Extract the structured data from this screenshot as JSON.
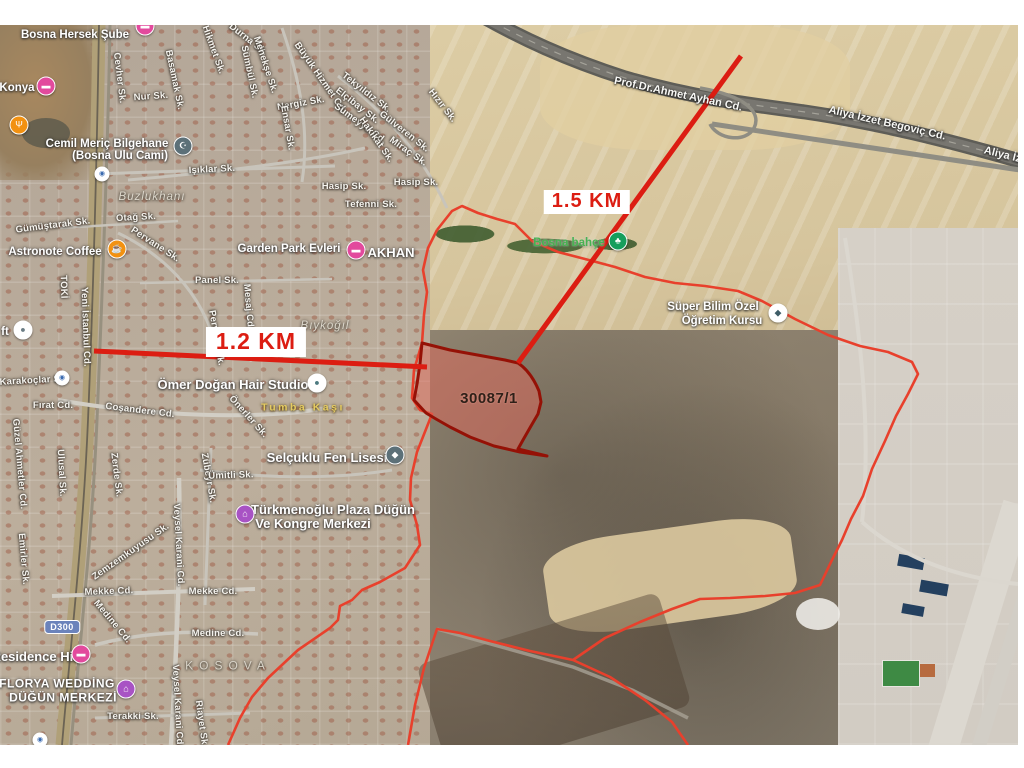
{
  "map": {
    "colors": {
      "measure_red": "#dc1d12",
      "boundary_red": "#e8402c",
      "parcel_stroke": "#951106",
      "parcel_fill": "rgba(222,106,92,0.52)",
      "pin_pink": "#e24a9d",
      "pin_purple": "#a853c4",
      "pin_orange": "#f29111",
      "pin_slate": "#5c7078",
      "pin_green": "#159e5c",
      "pin_white": "#ffffff"
    },
    "measure_labels": [
      {
        "t": "1.5 KM",
        "x": 587,
        "y": 202,
        "sm": true,
        "n": "distance-label-1-5-km"
      },
      {
        "t": "1.2 KM",
        "x": 256,
        "y": 342,
        "sm": false,
        "n": "distance-label-1-2-km"
      }
    ],
    "labels": [
      {
        "t": "30087/1",
        "x": 489,
        "y": 399,
        "c": "parcel-num",
        "n": "parcel-number-label"
      },
      {
        "t": "Bosna Hersek Şube",
        "x": 75,
        "y": 35,
        "c": "poi",
        "n": "poi-label-bosna-hersek-sube",
        "i": true
      },
      {
        "t": "Konya",
        "x": 17,
        "y": 88,
        "c": "poi",
        "n": "poi-label-konya",
        "i": true
      },
      {
        "t": "Cemil Meriç Bilgehane",
        "x": 107,
        "y": 144,
        "c": "poi",
        "n": "poi-label-cemil-meric-bilgehane",
        "i": true
      },
      {
        "t": "(Bosna Ulu Cami)",
        "x": 120,
        "y": 156,
        "c": "poi",
        "n": "poi-label-bosna-ulu-cami",
        "i": true
      },
      {
        "t": "Astronote Coffee",
        "x": 55,
        "y": 252,
        "c": "poi",
        "n": "poi-label-astronote-coffee",
        "i": true
      },
      {
        "t": "Garden Park Evleri",
        "x": 289,
        "y": 249,
        "c": "poi",
        "n": "poi-label-garden-park-evleri",
        "i": true
      },
      {
        "t": "AKHAN",
        "x": 391,
        "y": 253,
        "c": "poi-lg",
        "n": "poi-label-akhan",
        "i": true
      },
      {
        "t": "ft",
        "x": 5,
        "y": 332,
        "c": "poi",
        "n": "poi-label-ft",
        "i": true
      },
      {
        "t": "Ömer Doğan Hair Studio",
        "x": 233,
        "y": 385,
        "c": "poi-lg",
        "n": "poi-label-omer-dogan-hair-studio",
        "i": true
      },
      {
        "t": "Bosna bahçe",
        "x": 569,
        "y": 243,
        "c": "green-label",
        "n": "poi-label-bosna-bahce",
        "i": true
      },
      {
        "t": "Süper Bilim Özel",
        "x": 713,
        "y": 307,
        "c": "poi",
        "n": "poi-label-super-bilim-ozel",
        "i": true
      },
      {
        "t": "Öğretim Kursu",
        "x": 722,
        "y": 321,
        "c": "poi",
        "n": "poi-label-ogretim-kursu",
        "i": true
      },
      {
        "t": "Selçuklu Fen Lisesi",
        "x": 327,
        "y": 458,
        "c": "poi-lg",
        "n": "poi-label-selcuklu-fen-lisesi",
        "i": true
      },
      {
        "t": "Türkmenoğlu Plaza Düğün",
        "x": 333,
        "y": 510,
        "c": "poi-lg",
        "n": "poi-label-turkmenoglu-plaza",
        "i": true
      },
      {
        "t": "Ve Kongre Merkezi",
        "x": 313,
        "y": 524,
        "c": "poi-lg",
        "n": "poi-label-kongre-merkezi",
        "i": true
      },
      {
        "t": "Residence Hill",
        "x": 36,
        "y": 657,
        "c": "poi-lg",
        "n": "poi-label-residence-hill",
        "i": true
      },
      {
        "t": "FLORYA WEDDİNG",
        "x": 57,
        "y": 684,
        "c": "poi-caps",
        "n": "poi-label-florya-wedding",
        "i": true
      },
      {
        "t": "DÜĞÜN MERKEZİ",
        "x": 63,
        "y": 698,
        "c": "poi-caps",
        "n": "poi-label-dugun-merkezi",
        "i": true
      },
      {
        "t": "Buzlukhanı",
        "x": 152,
        "y": 197,
        "c": "district",
        "n": "district-label-buzlukhani"
      },
      {
        "t": "Bıykoğıl",
        "x": 325,
        "y": 326,
        "c": "district",
        "n": "district-label-biykogil"
      },
      {
        "t": "KOSOVA",
        "x": 228,
        "y": 666,
        "c": "caps",
        "n": "district-label-kosova"
      },
      {
        "t": "Tumba Kaşı",
        "x": 303,
        "y": 408,
        "c": "yellow",
        "n": "area-label-tumba-kasi"
      },
      {
        "t": "Prof.Dr.Ahmet Ayhan Cd.",
        "x": 678,
        "y": 95,
        "r": 12,
        "c": "road-label",
        "n": "road-label-prof-dr-ahmet-ayhan"
      },
      {
        "t": "Aliya İzzet Begoviç Cd.",
        "x": 887,
        "y": 124,
        "r": 13,
        "c": "road-label",
        "n": "road-label-aliya-izzet-begovic"
      },
      {
        "t": "Aliya İzze",
        "x": 1008,
        "y": 157,
        "r": 14,
        "c": "road-label",
        "n": "road-label-aliya-izzet-edge"
      },
      {
        "t": "Cevher Sk.",
        "x": 119,
        "y": 78,
        "r": 83
      },
      {
        "t": "Nur Sk.",
        "x": 151,
        "y": 97,
        "r": -4
      },
      {
        "t": "Basamak Sk.",
        "x": 174,
        "y": 80,
        "r": 78
      },
      {
        "t": "Hikmet Sk.",
        "x": 213,
        "y": 50,
        "r": 70
      },
      {
        "t": "Durna Sk.",
        "x": 248,
        "y": 40,
        "r": 38
      },
      {
        "t": "Menekşe Sk.",
        "x": 265,
        "y": 65,
        "r": 72
      },
      {
        "t": "Sümbül Sk.",
        "x": 249,
        "y": 72,
        "r": 78
      },
      {
        "t": "Büyük Hizmet Cd.",
        "x": 320,
        "y": 78,
        "r": 55
      },
      {
        "t": "Nergiz Sk.",
        "x": 301,
        "y": 104,
        "r": -10
      },
      {
        "t": "Ensar Sk.",
        "x": 287,
        "y": 128,
        "r": 80
      },
      {
        "t": "Işıklar Sk.",
        "x": 212,
        "y": 170,
        "r": -3
      },
      {
        "t": "Tekyıldız Sk.",
        "x": 366,
        "y": 93,
        "r": 38
      },
      {
        "t": "Elçibay Sk.",
        "x": 357,
        "y": 106,
        "r": 38
      },
      {
        "t": "Sumeyye Cd.",
        "x": 360,
        "y": 124,
        "r": 36
      },
      {
        "t": "Hakikat Sk.",
        "x": 376,
        "y": 140,
        "r": 55
      },
      {
        "t": "Gülveren Sk.",
        "x": 404,
        "y": 132,
        "r": 38
      },
      {
        "t": "Miraç Sk.",
        "x": 408,
        "y": 152,
        "r": 35
      },
      {
        "t": "Hızır Sk.",
        "x": 442,
        "y": 106,
        "r": 52
      },
      {
        "t": "Hasip Sk.",
        "x": 344,
        "y": 187,
        "r": 0
      },
      {
        "t": "Hasip Sk.",
        "x": 416,
        "y": 183,
        "r": 0
      },
      {
        "t": "Tefenni Sk.",
        "x": 371,
        "y": 205,
        "r": 0
      },
      {
        "t": "Gümüştarak Sk.",
        "x": 53,
        "y": 226,
        "r": -7
      },
      {
        "t": "Otağ Sk.",
        "x": 136,
        "y": 218,
        "r": -3
      },
      {
        "t": "Pervane Sk.",
        "x": 155,
        "y": 245,
        "r": 33
      },
      {
        "t": "Pervane Sk.",
        "x": 216,
        "y": 338,
        "r": 80
      },
      {
        "t": "Panel Sk.",
        "x": 217,
        "y": 281,
        "r": 0
      },
      {
        "t": "Mesaj Cd.",
        "x": 248,
        "y": 307,
        "r": 85
      },
      {
        "t": "TOKİ",
        "x": 63,
        "y": 287,
        "r": 88
      },
      {
        "t": "Yeni İstanbul Cd.",
        "x": 85,
        "y": 327,
        "r": 88
      },
      {
        "t": "Karakoçlar Sk.",
        "x": 34,
        "y": 381,
        "r": -3
      },
      {
        "t": "Fırat Cd.",
        "x": 53,
        "y": 406,
        "r": 0
      },
      {
        "t": "Coşandere Cd.",
        "x": 140,
        "y": 411,
        "r": 7
      },
      {
        "t": "Önerler Sk.",
        "x": 248,
        "y": 417,
        "r": 48
      },
      {
        "t": "Güzel Ahmetler Cd.",
        "x": 19,
        "y": 464,
        "r": 85
      },
      {
        "t": "Ulusal Sk.",
        "x": 61,
        "y": 473,
        "r": 87
      },
      {
        "t": "Zerde Sk.",
        "x": 116,
        "y": 475,
        "r": 83
      },
      {
        "t": "Zübeyr Sk.",
        "x": 208,
        "y": 478,
        "r": 80
      },
      {
        "t": "Ümitli Sk.",
        "x": 231,
        "y": 476,
        "r": -2
      },
      {
        "t": "Veysel Karani Cd.",
        "x": 178,
        "y": 545,
        "r": 87
      },
      {
        "t": "Veysel Karani Cd.",
        "x": 177,
        "y": 706,
        "r": 87
      },
      {
        "t": "Zemzemkuyusu Sk.",
        "x": 131,
        "y": 552,
        "r": -35
      },
      {
        "t": "Emirler Sk.",
        "x": 23,
        "y": 559,
        "r": 85
      },
      {
        "t": "Mekke Cd.",
        "x": 109,
        "y": 592,
        "r": -2
      },
      {
        "t": "Mekke Cd.",
        "x": 213,
        "y": 592,
        "r": 0
      },
      {
        "t": "Medine Cd.",
        "x": 112,
        "y": 622,
        "r": 50
      },
      {
        "t": "Medine Cd.",
        "x": 218,
        "y": 634,
        "r": 0
      },
      {
        "t": "Terakki Sk.",
        "x": 133,
        "y": 717,
        "r": 0
      },
      {
        "t": "Riayet Sk.",
        "x": 201,
        "y": 724,
        "r": 82
      }
    ],
    "pins": [
      {
        "x": 145,
        "y": 26,
        "bg": "#e24a9d",
        "g": "▬",
        "n": "bank-branch-pin-icon"
      },
      {
        "x": 46,
        "y": 86,
        "bg": "#e24a9d",
        "g": "▬",
        "n": "hotel-pin-icon"
      },
      {
        "x": 19,
        "y": 125,
        "bg": "#f29111",
        "g": "Ψ",
        "n": "restaurant-pin-icon"
      },
      {
        "x": 183,
        "y": 146,
        "bg": "#5c7078",
        "g": "☪",
        "n": "mosque-pin-icon"
      },
      {
        "x": 117,
        "y": 249,
        "bg": "#f29111",
        "g": "☕",
        "n": "coffee-pin-icon"
      },
      {
        "x": 356,
        "y": 250,
        "bg": "#e24a9d",
        "g": "▬",
        "n": "akhan-pin-icon"
      },
      {
        "x": 23,
        "y": 330,
        "bg": "#ffffff",
        "g": "●",
        "fg": "#6b7d85",
        "n": "loft-pin-icon"
      },
      {
        "x": 317,
        "y": 383,
        "bg": "#ffffff",
        "g": "●",
        "fg": "#4d7a80",
        "n": "hair-studio-pin-icon"
      },
      {
        "x": 618,
        "y": 241,
        "bg": "#159e5c",
        "g": "♣",
        "n": "park-pin-icon"
      },
      {
        "x": 778,
        "y": 313,
        "bg": "#ffffff",
        "g": "◆",
        "fg": "#3e5c66",
        "n": "education-pin-icon"
      },
      {
        "x": 395,
        "y": 455,
        "bg": "#5c7078",
        "g": "◆",
        "n": "school-pin-icon"
      },
      {
        "x": 245,
        "y": 514,
        "bg": "#a853c4",
        "g": "⌂",
        "n": "plaza-pin-icon"
      },
      {
        "x": 81,
        "y": 654,
        "bg": "#e24a9d",
        "g": "▬",
        "n": "residence-pin-icon"
      },
      {
        "x": 126,
        "y": 689,
        "bg": "#a853c4",
        "g": "⌂",
        "n": "wedding-venue-pin-icon"
      },
      {
        "x": 102,
        "y": 174,
        "bg": "#ffffff",
        "g": "◉",
        "fg": "#3a6ab0",
        "sm": true,
        "n": "transit-stop-icon"
      },
      {
        "x": 62,
        "y": 378,
        "bg": "#ffffff",
        "g": "◉",
        "fg": "#3a6ab0",
        "sm": true,
        "n": "transit-stop-icon"
      },
      {
        "x": 40,
        "y": 740,
        "bg": "#ffffff",
        "g": "◉",
        "fg": "#3a6ab0",
        "sm": true,
        "n": "transit-stop-icon"
      }
    ],
    "shield": {
      "t": "D300",
      "x": 62,
      "y": 627,
      "n": "road-shield-d300"
    },
    "roads": [
      {
        "d": "M455,0 C520,40 575,62 625,78 C690,97 745,104 805,112 C880,123 950,141 1020,161",
        "s": "#5e5d57",
        "w": 15
      },
      {
        "d": "M455,0 C520,40 575,62 625,78 C690,97 745,104 805,112 C880,123 950,141 1020,161",
        "s": "#787670",
        "w": 10
      },
      {
        "d": "M455,0 C520,40 575,62 625,78 C690,97 745,104 805,112 C880,123 950,141 1020,161",
        "s": "#a5a39a",
        "w": 1.2,
        "da": "7 7"
      },
      {
        "d": "M712,124 C800,138 905,152 1020,170",
        "s": "#8f8d83",
        "w": 5
      },
      {
        "d": "M700,88 C745,96 762,112 754,128 C746,143 718,140 710,124",
        "s": "#8f8d83",
        "w": 3.5
      },
      {
        "d": "M99,25 C97,150 93,300 88,420 C83,540 70,650 62,745",
        "s": "#b0a078",
        "w": 13
      },
      {
        "d": "M99,25 C97,150 93,300 88,420 C83,540 70,650 62,745",
        "s": "#6b6354",
        "w": 1.8
      },
      {
        "d": "M110,25 C108,150 102,300 97,420 C92,540 79,650 71,745",
        "s": "#97907f",
        "w": 3
      },
      {
        "d": "M58,400 C150,416 260,421 332,407",
        "s": "#d2cec5",
        "w": 4
      },
      {
        "d": "M52,596 L255,589",
        "s": "#d2cec5",
        "w": 4
      },
      {
        "d": "M95,645 C150,630 205,631 258,634",
        "s": "#cbc7be",
        "w": 3.5
      },
      {
        "d": "M179,478 C181,560 176,660 171,745",
        "s": "#d2cec5",
        "w": 4.5
      },
      {
        "d": "M211,448 L205,605",
        "s": "#c8c4bb",
        "w": 3
      },
      {
        "d": "M95,174 L335,166",
        "s": "#c8c4bb",
        "w": 3
      },
      {
        "d": "M128,180 C220,172 305,162 365,148",
        "s": "#c8c4bb",
        "w": 3
      },
      {
        "d": "M118,233 C170,258 208,300 220,362",
        "s": "#c8c4bb",
        "w": 3
      },
      {
        "d": "M246,283 L251,362",
        "s": "#c8c4bb",
        "w": 2.5
      },
      {
        "d": "M140,283 L332,279",
        "s": "#c8c4bb",
        "w": 2.5
      },
      {
        "d": "M338,76 C380,108 420,150 447,208",
        "s": "#c8c4bb",
        "w": 3
      },
      {
        "d": "M282,28 C300,80 310,130 302,182",
        "s": "#c8c4bb",
        "w": 3
      },
      {
        "d": "M60,228 L178,221",
        "s": "#c8c4bb",
        "w": 2.5
      },
      {
        "d": "M200,470 C260,478 330,480 392,470",
        "s": "#c8c4bb",
        "w": 3
      },
      {
        "d": "M95,718 L250,713",
        "s": "#c8c4bb",
        "w": 3
      },
      {
        "d": "M845,238 C860,330 872,430 862,522",
        "s": "#dbd7cf",
        "w": 4
      },
      {
        "d": "M862,522 C905,560 960,578 1018,584",
        "s": "#dbd7cf",
        "w": 4
      },
      {
        "d": "M437,629 L573,667 632,690 688,718",
        "s": "#a8a195",
        "w": 3.5,
        "o": 0.8
      }
    ],
    "red": [
      {
        "d": "M437,230 L452,211 462,206 478,213 497,219 515,224 532,241 558,252 585,259 615,267 645,277 675,283 705,286 738,291 762,301 795,319 828,335 860,346 888,352 912,362 918,374 908,394 896,416 885,441 872,469 863,496 851,519 842,540 831,562 820,585 795,593 765,596 730,598 700,599 672,609 640,622 605,638 573,660 610,677 645,700 672,722 688,745",
        "s": "#e8402c",
        "w": 2.6,
        "n": "cadastral-boundary-line"
      },
      {
        "d": "M573,660 L530,651 490,641 460,633 437,629 424,668 415,705 408,745",
        "s": "#e8402c",
        "w": 2.6,
        "n": "cadastral-boundary-line"
      },
      {
        "d": "M437,230 L428,248 423,270 427,292 424,315 422,343 414,370 412,398 420,410 432,414 417,452 411,478 410,500 417,525 420,545 405,568 380,582 362,590 352,600 340,606 338,620 330,628 298,650 268,678 252,697 240,718 228,745",
        "s": "#e8402c",
        "w": 2.6,
        "n": "cadastral-boundary-line"
      },
      {
        "d": "M422,343 L450,350 483,356 505,360 518,363 C527,369 534,379 539,391 L541,402 538,414 531,426 523,440 518,449 L547,456 520,452 494,446 470,437 450,427 436,419 426,413 414,400 417,384 420,364 Z",
        "s": "#951106",
        "w": 3,
        "f": "rgba(222,106,92,0.52)",
        "n": "highlighted-parcel-30087-1",
        "i": true
      },
      {
        "d": "M741,56 L518,363",
        "s": "#dc1d12",
        "w": 5,
        "n": "measure-line-1-5-km"
      },
      {
        "d": "M94,351 L427,367",
        "s": "#dc1d12",
        "w": 5,
        "n": "measure-line-1-2-km"
      }
    ]
  }
}
